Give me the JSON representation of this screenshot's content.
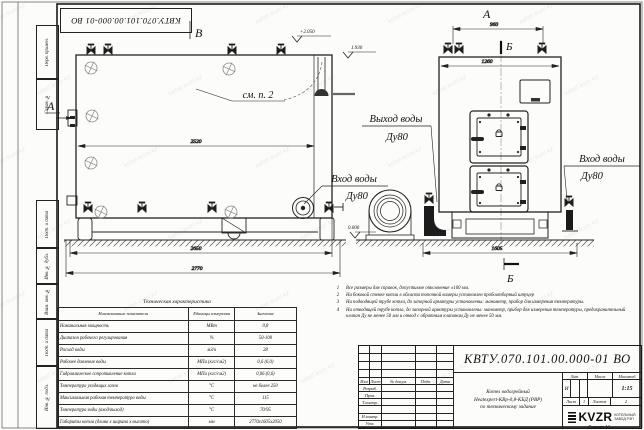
{
  "sheet": {
    "stamp_number": "КВТУ.070.101.00.000-01 ВО",
    "format_label": "Формат А3",
    "watermark": "kotel-kvzr.kz"
  },
  "frame_columns": [
    "Перв. примен.",
    "Справ. №",
    "Подп. и дата",
    "Инв. № дубл.",
    "Взам. инв. №",
    "Подп. и дата",
    "Инв. № подл."
  ],
  "drawing": {
    "view_b": "В",
    "view_a_side": "А",
    "view_a_top": "А",
    "section_b_top": "Б",
    "section_b_bottom": "Б",
    "see_note": "см. п. 2",
    "elev_top": "+2.050",
    "elev_mid": "1.930",
    "elev_zero": "0.000",
    "dim_2520": "2520",
    "dim_2650": "2650",
    "dim_2770": "2770",
    "dim_960": "960",
    "dim_1260": "1260",
    "dim_1605": "1605",
    "outlet_label": "Выход воды",
    "outlet_dn": "Ду80",
    "inlet_label_side": "Вход воды",
    "inlet_dn_side": "Ду80",
    "inlet_label_front": "Вход воды",
    "inlet_dn_front": "Ду80"
  },
  "tech_table": {
    "title": "Техническая характеристика",
    "headers": [
      "Наименование показателя",
      "Единицы измерения",
      "Значение"
    ],
    "rows": [
      [
        "Номинальная мощность",
        "МВт",
        "0,8"
      ],
      [
        "Диапазон рабочего регулирования",
        "%",
        "50-100"
      ],
      [
        "Расход воды",
        "м3/ч",
        "28"
      ],
      [
        "Рабочее давление воды",
        "МПа (кгс/см2)",
        "0,6 (6,0)"
      ],
      [
        "Гидравлическое сопротивление котла",
        "МПа (кгс/см2)",
        "0,06 (0,6)"
      ],
      [
        "Температура уходящих газов",
        "°С",
        "не более 250"
      ],
      [
        "Максимальная рабочая температура воды",
        "°С",
        "115"
      ],
      [
        "Температура воды (вход/выход)",
        "°С",
        "70/95"
      ],
      [
        "Габариты котла (длина х ширина х высота)",
        "мм",
        "2770х1605х2050"
      ]
    ]
  },
  "notes": [
    "Все размеры для справок, допустимое отклонение ±100 мм.",
    "На боковой стенке котла в области топочной камеры установлен пробоотборный штуцер",
    "На подводящей трубе котла, до запорной арматуры установлены: манометр, прибор для измерения температуры.",
    "На отводящей трубе котла, до запорной арматуры установлены: манометр, прибор для измерения температуры, предохранительный клапан Ду не менее 50 мм и отвод с обратным клапаном Ду не менее 50 мм."
  ],
  "title_block": {
    "doc_number": "КВТУ.070.101.00.000-01 ВО",
    "header_cols": [
      "Изм",
      "Лист",
      "№ докум.",
      "Подп.",
      "Дата"
    ],
    "row_labels": [
      "Разраб.",
      "Пров.",
      "Т.контр.",
      "",
      "Н.контр.",
      "Утв."
    ],
    "name_lines": [
      "Котел водогрейный",
      "Heatexpert-КВр-0,8-КБД (РВР)",
      "по техническому задание"
    ],
    "lit_label": "Лит.",
    "mass_label": "Масса",
    "scale_label": "Масштаб",
    "lit_value": "И",
    "scale_value": "1:15",
    "sheet_label": "Лист",
    "sheet_value": "1",
    "sheets_label": "Листов",
    "sheets_value": "2",
    "logo_text": "KVZR",
    "org_line1": "КОТЕЛЬНЫЙ",
    "org_line2": "ЗАВОД РЭП"
  }
}
